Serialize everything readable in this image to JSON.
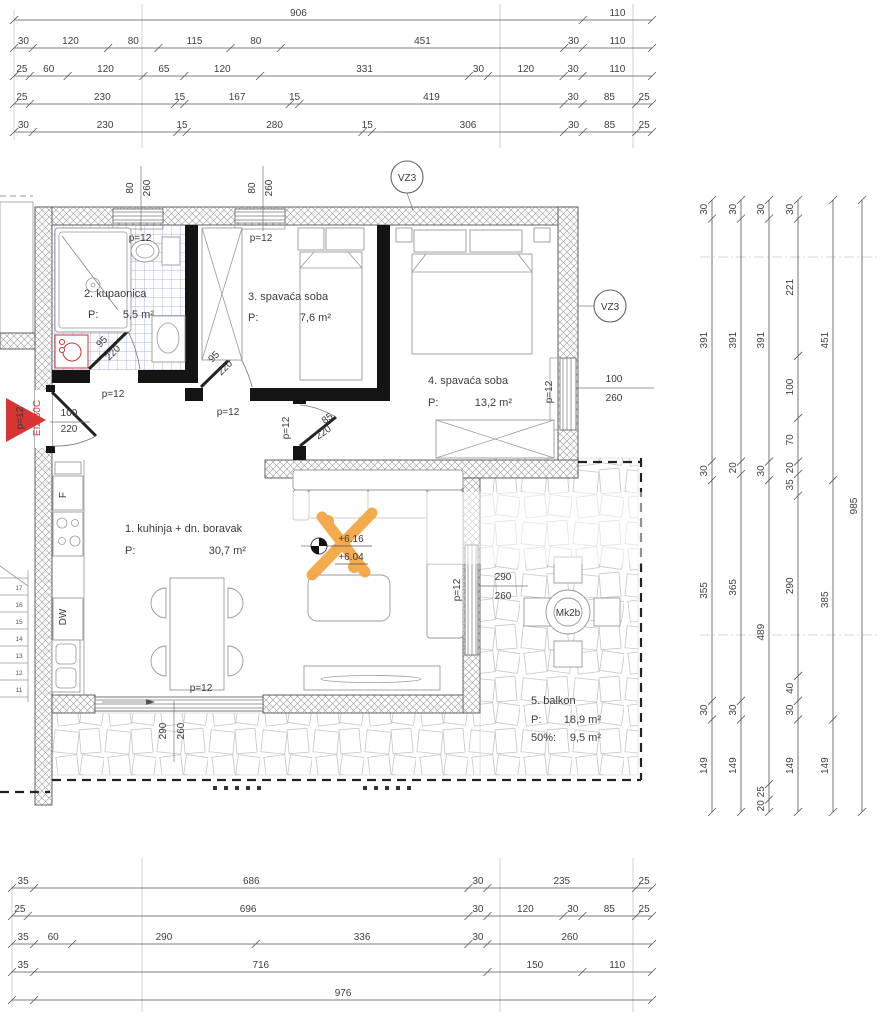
{
  "rooms": {
    "kitchen": {
      "name": "1. kuhinja + dn. boravak",
      "p": "P:",
      "area": "30,7 m²"
    },
    "bathroom": {
      "name": "2. kupaonica",
      "p": "P:",
      "area": "5,5 m²"
    },
    "bedroom3": {
      "name": "3. spavaća soba",
      "p": "P:",
      "area": "7,6 m²"
    },
    "bedroom4": {
      "name": "4. spavaća soba",
      "p": "P:",
      "area": "13,2 m²"
    },
    "balcony": {
      "name": "5. balkon",
      "p": "P:",
      "area": "18,9 m²",
      "half_label": "50%:",
      "half_area": "9,5 m²"
    }
  },
  "annotations": {
    "vz3": "VZ3",
    "mk2b": "Mk2b",
    "elev_top": "+6.16",
    "elev_bottom": "+6.04",
    "fridge": "F",
    "dishwasher": "DW"
  },
  "stairs": {
    "steps": [
      "11",
      "12",
      "13",
      "14",
      "15",
      "16",
      "17"
    ]
  },
  "plan_labels": [
    {
      "t": "80",
      "x": 133,
      "y": 188,
      "r": -90
    },
    {
      "t": "260",
      "x": 150,
      "y": 188,
      "r": -90
    },
    {
      "t": "p=12",
      "x": 140,
      "y": 241,
      "r": 0
    },
    {
      "t": "80",
      "x": 255,
      "y": 188,
      "r": -90
    },
    {
      "t": "260",
      "x": 272,
      "y": 188,
      "r": -90
    },
    {
      "t": "p=12",
      "x": 261,
      "y": 241,
      "r": 0
    },
    {
      "t": "95",
      "x": 104,
      "y": 344,
      "r": -45
    },
    {
      "t": "220",
      "x": 115,
      "y": 355,
      "r": -45
    },
    {
      "t": "p=12",
      "x": 113,
      "y": 397,
      "r": 0
    },
    {
      "t": "95",
      "x": 216,
      "y": 359,
      "r": -45
    },
    {
      "t": "220",
      "x": 227,
      "y": 370,
      "r": -45
    },
    {
      "t": "p=12",
      "x": 228,
      "y": 415,
      "r": 0
    },
    {
      "t": "85",
      "x": 329,
      "y": 421,
      "r": -35
    },
    {
      "t": "220",
      "x": 325,
      "y": 435,
      "r": -35
    },
    {
      "t": "p=12",
      "x": 289,
      "y": 428,
      "r": -90
    },
    {
      "t": "p=12",
      "x": 23,
      "y": 418,
      "r": -90
    },
    {
      "t": "100",
      "x": 69,
      "y": 416,
      "r": 0
    },
    {
      "t": "220",
      "x": 69,
      "y": 432,
      "r": 0
    },
    {
      "t": "EI2 30C",
      "x": 40,
      "y": 418,
      "r": -90,
      "c": "red"
    },
    {
      "t": "100",
      "x": 614,
      "y": 382,
      "r": 0
    },
    {
      "t": "260",
      "x": 614,
      "y": 401,
      "r": 0
    },
    {
      "t": "p=12",
      "x": 552,
      "y": 392,
      "r": -90
    },
    {
      "t": "290",
      "x": 503,
      "y": 580,
      "r": 0
    },
    {
      "t": "260",
      "x": 503,
      "y": 599,
      "r": 0
    },
    {
      "t": "p=12",
      "x": 460,
      "y": 590,
      "r": -90
    },
    {
      "t": "290",
      "x": 166,
      "y": 731,
      "r": -90
    },
    {
      "t": "260",
      "x": 184,
      "y": 731,
      "r": -90
    },
    {
      "t": "p=12",
      "x": 201,
      "y": 691,
      "r": 0
    }
  ],
  "dimensions": {
    "top": [
      {
        "y": 20,
        "x1": 14,
        "x2": 652,
        "segs": [
          {
            "v": 906,
            "t": "906"
          },
          {
            "v": 110,
            "t": "110"
          }
        ]
      },
      {
        "y": 48,
        "x1": 14,
        "x2": 652,
        "segs": [
          {
            "v": 30,
            "t": "30"
          },
          {
            "v": 120,
            "t": "120"
          },
          {
            "v": 80,
            "t": "80"
          },
          {
            "v": 115,
            "t": "115"
          },
          {
            "v": 80,
            "t": "80"
          },
          {
            "v": 451,
            "t": "451"
          },
          {
            "v": 30,
            "t": "30"
          },
          {
            "v": 110,
            "t": "110"
          }
        ]
      },
      {
        "y": 76,
        "x1": 14,
        "x2": 652,
        "segs": [
          {
            "v": 25,
            "t": "25"
          },
          {
            "v": 60,
            "t": "60"
          },
          {
            "v": 120,
            "t": "120"
          },
          {
            "v": 65,
            "t": "65"
          },
          {
            "v": 120,
            "t": "120"
          },
          {
            "v": 331,
            "t": "331"
          },
          {
            "v": 30,
            "t": "30"
          },
          {
            "v": 120,
            "t": "120"
          },
          {
            "v": 30,
            "t": "30"
          },
          {
            "v": 110,
            "t": "110"
          }
        ]
      },
      {
        "y": 104,
        "x1": 14,
        "x2": 652,
        "segs": [
          {
            "v": 25,
            "t": "25"
          },
          {
            "v": 230,
            "t": "230"
          },
          {
            "v": 15,
            "t": "15"
          },
          {
            "v": 167,
            "t": "167"
          },
          {
            "v": 15,
            "t": "15"
          },
          {
            "v": 419,
            "t": "419"
          },
          {
            "v": 30,
            "t": "30"
          },
          {
            "v": 85,
            "t": "85"
          },
          {
            "v": 25,
            "t": "25"
          }
        ]
      },
      {
        "y": 132,
        "x1": 14,
        "x2": 652,
        "segs": [
          {
            "v": 30,
            "t": "30"
          },
          {
            "v": 230,
            "t": "230"
          },
          {
            "v": 15,
            "t": "15"
          },
          {
            "v": 280,
            "t": "280"
          },
          {
            "v": 15,
            "t": "15"
          },
          {
            "v": 306,
            "t": "306"
          },
          {
            "v": 30,
            "t": "30"
          },
          {
            "v": 85,
            "t": "85"
          },
          {
            "v": 25,
            "t": "25"
          }
        ]
      }
    ],
    "bottom": [
      {
        "y": 888,
        "x1": 12,
        "x2": 652,
        "segs": [
          {
            "v": 35,
            "t": "35"
          },
          {
            "v": 686,
            "t": "686"
          },
          {
            "v": 30,
            "t": "30"
          },
          {
            "v": 235,
            "t": "235"
          },
          {
            "v": 25,
            "t": "25"
          }
        ]
      },
      {
        "y": 916,
        "x1": 12,
        "x2": 652,
        "segs": [
          {
            "v": 25,
            "t": "25"
          },
          {
            "v": 696,
            "t": "696"
          },
          {
            "v": 30,
            "t": "30"
          },
          {
            "v": 120,
            "t": "120"
          },
          {
            "v": 30,
            "t": "30"
          },
          {
            "v": 85,
            "t": "85"
          },
          {
            "v": 25,
            "t": "25"
          }
        ]
      },
      {
        "y": 944,
        "x1": 12,
        "x2": 652,
        "segs": [
          {
            "v": 35,
            "t": "35"
          },
          {
            "v": 60,
            "t": "60"
          },
          {
            "v": 290,
            "t": "290"
          },
          {
            "v": 336,
            "t": "336"
          },
          {
            "v": 30,
            "t": "30"
          },
          {
            "v": 260,
            "t": "260"
          }
        ]
      },
      {
        "y": 972,
        "x1": 12,
        "x2": 652,
        "segs": [
          {
            "v": 35,
            "t": "35"
          },
          {
            "v": 716,
            "t": "716"
          },
          {
            "v": 150,
            "t": "150"
          },
          {
            "v": 110,
            "t": "110"
          }
        ]
      },
      {
        "y": 1000,
        "x1": 12,
        "x2": 652,
        "segs": [
          {
            "v": 35,
            "t": ""
          },
          {
            "v": 976,
            "t": "976"
          }
        ]
      }
    ],
    "right": [
      {
        "x": 712,
        "y1": 200,
        "y2": 812,
        "segs": [
          {
            "v": 30,
            "t": "30"
          },
          {
            "v": 391,
            "t": "391"
          },
          {
            "v": 30,
            "t": "30"
          },
          {
            "v": 355,
            "t": "355"
          },
          {
            "v": 30,
            "t": "30"
          },
          {
            "v": 149,
            "t": "149"
          }
        ]
      },
      {
        "x": 741,
        "y1": 200,
        "y2": 812,
        "segs": [
          {
            "v": 30,
            "t": "30"
          },
          {
            "v": 391,
            "t": "391"
          },
          {
            "v": 20,
            "t": "20"
          },
          {
            "v": 365,
            "t": "365"
          },
          {
            "v": 30,
            "t": "30"
          },
          {
            "v": 149,
            "t": "149"
          }
        ]
      },
      {
        "x": 769,
        "y1": 200,
        "y2": 812,
        "segs": [
          {
            "v": 30,
            "t": "30"
          },
          {
            "v": 391,
            "t": "391"
          },
          {
            "v": 30,
            "t": "30"
          },
          {
            "v": 489,
            "t": "489"
          },
          {
            "v": 25,
            "t": "25"
          },
          {
            "v": 20,
            "t": "20"
          }
        ]
      },
      {
        "x": 798,
        "y1": 200,
        "y2": 812,
        "segs": [
          {
            "v": 30,
            "t": "30"
          },
          {
            "v": 221,
            "t": "221"
          },
          {
            "v": 100,
            "t": "100"
          },
          {
            "v": 70,
            "t": "70"
          },
          {
            "v": 20,
            "t": "20"
          },
          {
            "v": 35,
            "t": "35"
          },
          {
            "v": 290,
            "t": "290"
          },
          {
            "v": 40,
            "t": "40"
          },
          {
            "v": 30,
            "t": "30"
          },
          {
            "v": 149,
            "t": "149"
          }
        ]
      },
      {
        "x": 833,
        "y1": 200,
        "y2": 812,
        "segs": [
          {
            "v": 451,
            "t": "451"
          },
          {
            "v": 385,
            "t": "385"
          },
          {
            "v": 149,
            "t": "149"
          }
        ]
      },
      {
        "x": 862,
        "y1": 200,
        "y2": 812,
        "segs": [
          {
            "v": 985,
            "t": "985"
          }
        ]
      }
    ]
  },
  "colors": {
    "accent_orange": "#f2a43f",
    "entry_red": "#d83434",
    "tile_blue": "#96a0d4",
    "appliance_red": "#cc3333"
  }
}
